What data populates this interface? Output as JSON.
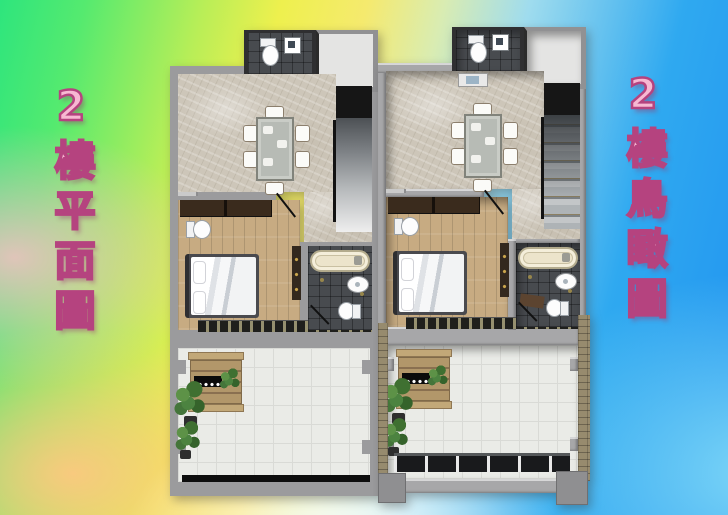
{
  "captions": {
    "left": "2樓平面圖",
    "right": "2樓鳥瞰圖"
  },
  "palette": {
    "caption_fill": "#f7b8d2",
    "caption_outline": "#b5437f",
    "bg_green": "#2ee57d",
    "bg_yellow": "#eef04e",
    "bg_pink": "#f8bec6",
    "bg_orange": "#fcc880",
    "bg_blue": "#2193f0",
    "bg_cyan": "#8ce2f8",
    "bg_white": "#ffffff",
    "wall_gray": "#9b9b9d",
    "dark_wall": "#161616",
    "marble_floor": "#cdc6b9",
    "wood_floor": "#c7ab82",
    "bath_tile": "#484b4f",
    "terrace_tile": "#eaebe7",
    "bathtub_cream": "#ece4cb",
    "wardrobe_brown": "#3a2b1d",
    "bench_wood": "#b2976a",
    "plant_green": "#4c8340",
    "stair_gray": "#8b8f93"
  }
}
